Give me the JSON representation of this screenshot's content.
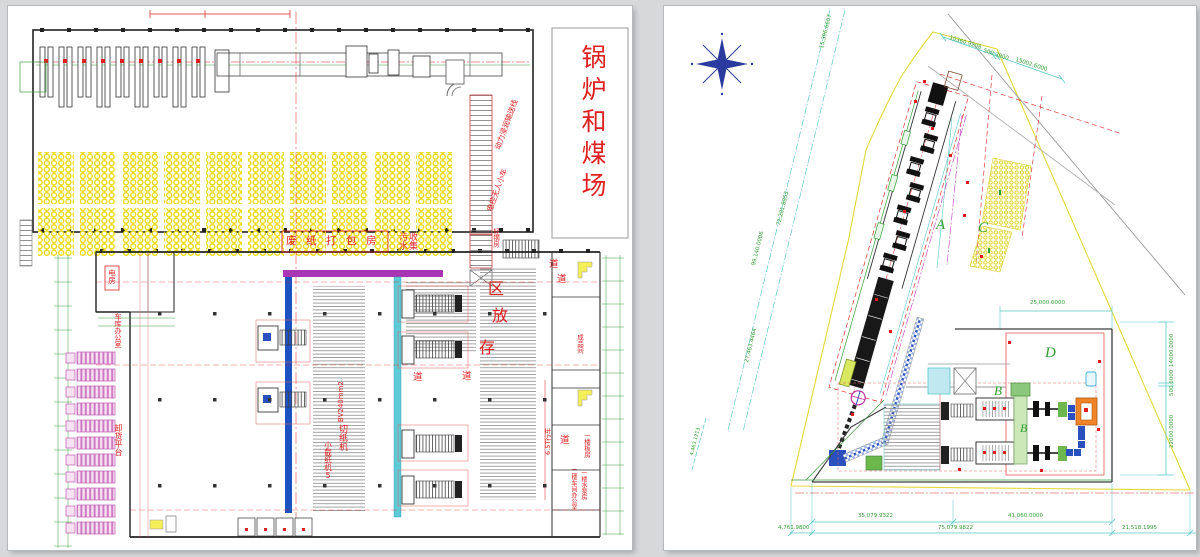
{
  "colors": {
    "red": "#e02020",
    "green": "#2f9e2f",
    "cyan": "#58c8c8",
    "yellow": "#f0e428",
    "pink": "#d883c8",
    "blue": "#1d52c0",
    "magenta": "#a836b4",
    "compass_blue": "#2a3a9e",
    "orange": "#f08428"
  },
  "left_sheet": {
    "labels": {
      "boiler_coal_yard": "锅炉和煤场",
      "waste_paper_packing_room": "废纸打包房",
      "sewage_col1": "污水",
      "sewage_col2": "收集",
      "storage_char_1": "存",
      "storage_char_2": "放",
      "storage_char_3": "区",
      "aisle": "道",
      "paper_cutter": "切纸机",
      "small_paper_cutter": "小截纸机5",
      "cable_spec": "BV240mm2",
      "unloading_platform": "卸货平台",
      "garage_office": "车库办公室",
      "electric_room": "电房",
      "crane": "6.5T行车",
      "finished_goods_room": "成品间",
      "ground_floor_room": "一楼板房",
      "second_floor_office": "二楼车间办公室",
      "pump_room": "一楼水泵房",
      "power_conveyor": "动力浸润输送线",
      "agv_cart": "电控无人小车",
      "light_steel_room": "轻钢房"
    }
  },
  "right_sheet": {
    "area_labels": {
      "a": "A",
      "b": "B",
      "b_italic": "B",
      "c": "C",
      "d": "D"
    },
    "dimensions": {
      "top_1": "10360.9208",
      "top_2": "500.3900",
      "top_3": "15002.6000",
      "left_1": "15,396.6607",
      "left_2": "72,281.8853",
      "left_3": "99,140.0006",
      "left_4": "27,463.4464",
      "left_5": "4,463.1213",
      "right_top": "25,000.0000",
      "right_v1": "14000.0000",
      "right_v2": "500.6000",
      "right_v3": "22000.0000",
      "bottom_r1a": "35,079.9322",
      "bottom_r1b": "41,060.0000",
      "bottom_r2a": "4,761.9800",
      "bottom_r2b": "75,079.9822",
      "bottom_r2c": "21,518.1995"
    }
  }
}
